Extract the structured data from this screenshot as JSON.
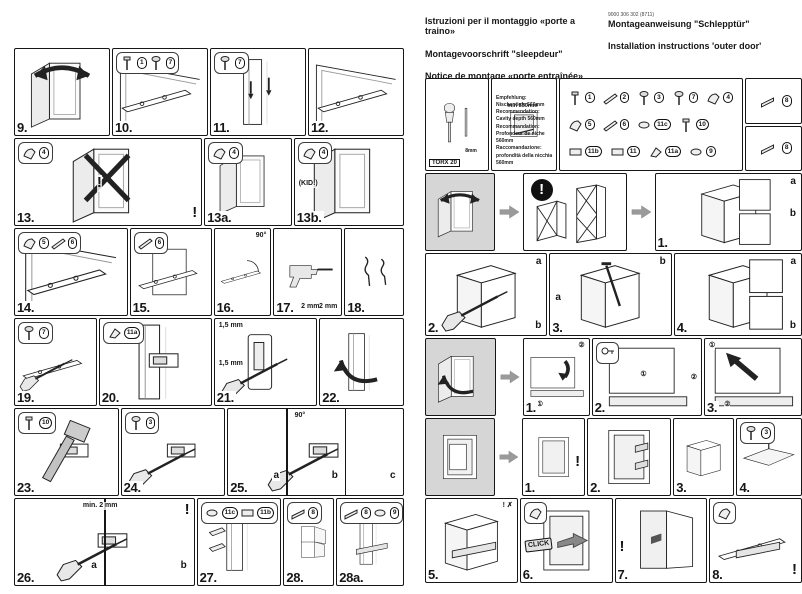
{
  "document": {
    "kind": "scanned appliance installation manual, two pages",
    "page_bg": "#ffffff",
    "ink": "#161616",
    "gray_fill": "#d6d6d6"
  },
  "header": {
    "doc_code": "9000 306 302 (8711)",
    "title_it": "Istruzioni per il montaggio «porte a traino»",
    "title_de": "Montageanweisung \"Schlepptür\"",
    "title_nl": "Montagevoorschrift \"sleepdeur\"",
    "title_en": "Installation instructions 'outer door'",
    "title_fr": "Notice de montage «porte entraînée»"
  },
  "tools_box": {
    "tool_label": "TORX 20",
    "bit_label": "8mm"
  },
  "niche_box": {
    "dim_label": "min 550mm",
    "recommendations": [
      "Empfehlung: Nischentiefe 560mm",
      "Recommendation: Cavity depth 560mm",
      "Recommandation: Profondeur de niche 560mm",
      "Raccomandazione: profondità della nicchia 560mm"
    ]
  },
  "parts_box": {
    "main_parts": [
      {
        "id": "1",
        "icon": "pin-icon"
      },
      {
        "id": "2",
        "icon": "rail-icon"
      },
      {
        "id": "3",
        "icon": "screw-icon"
      },
      {
        "id": "7",
        "icon": "screw-icon"
      },
      {
        "id": "4",
        "icon": "bracket-icon"
      },
      {
        "id": "5",
        "icon": "bracket-icon"
      },
      {
        "id": "6",
        "icon": "rail-icon"
      },
      {
        "id": "11c",
        "icon": "cap-icon"
      },
      {
        "id": "10",
        "icon": "pin-icon"
      },
      {
        "id": "11b",
        "icon": "slider-icon"
      },
      {
        "id": "11",
        "icon": "slider-icon"
      },
      {
        "id": "11a",
        "icon": "clip-icon"
      },
      {
        "id": "9",
        "icon": "cap-icon"
      }
    ],
    "side_parts": [
      {
        "id": "8",
        "icon": "strip-icon"
      },
      {
        "id": "8",
        "icon": "strip-icon"
      }
    ]
  },
  "left_page": {
    "rows": [
      {
        "steps": [
          {
            "label": "9.",
            "art": [
              "door",
              "arrowCurve"
            ]
          },
          {
            "label": "10.",
            "art": [
              "frame",
              "bar"
            ],
            "insets": [
              {
                "parts": [
                  "1",
                  "7"
                ]
              }
            ]
          },
          {
            "label": "11.",
            "art": [
              "doorEdge",
              "screwPair"
            ],
            "insets": [
              {
                "parts": [
                  "7"
                ]
              }
            ]
          },
          {
            "label": "12.",
            "art": [
              "frame",
              "bar"
            ]
          }
        ]
      },
      {
        "steps": [
          {
            "label": "13.",
            "art": [
              "door",
              "crossX"
            ],
            "insets": [
              {
                "parts": [
                  "4"
                ]
              }
            ],
            "notes": [
              {
                "t": "!",
                "pos": "c"
              },
              {
                "t": "!",
                "pos": "br"
              }
            ]
          },
          {
            "label": "13a.",
            "art": [
              "door"
            ],
            "insets": [
              {
                "parts": [
                  "4"
                ]
              }
            ]
          },
          {
            "label": "13b.",
            "art": [
              "door"
            ],
            "insets": [
              {
                "parts": [
                  "4"
                ]
              }
            ],
            "notes": [
              {
                "t": "(KID!)",
                "pos": "cl"
              }
            ]
          }
        ]
      },
      {
        "steps": [
          {
            "label": "14.",
            "art": [
              "frame",
              "bar"
            ],
            "insets": [
              {
                "parts": [
                  "5",
                  "6"
                ]
              }
            ]
          },
          {
            "label": "15.",
            "art": [
              "doorPanel",
              "bar"
            ],
            "insets": [
              {
                "parts": [
                  "6"
                ]
              }
            ]
          },
          {
            "label": "16.",
            "art": [
              "bar",
              "arc90"
            ],
            "notes": [
              {
                "t": "90°",
                "pos": "tr"
              }
            ]
          },
          {
            "label": "17.",
            "art": [
              "drillP"
            ],
            "notes": [
              {
                "t": "2 mm",
                "pos": "bc"
              },
              {
                "t": "2 mm",
                "pos": "br"
              }
            ]
          },
          {
            "label": "18.",
            "art": [
              "clipsP"
            ]
          }
        ]
      },
      {
        "steps": [
          {
            "label": "19.",
            "art": [
              "bar",
              "driver"
            ],
            "insets": [
              {
                "parts": [
                  "7"
                ]
              }
            ]
          },
          {
            "label": "20.",
            "art": [
              "doorEdge",
              "sliderRect"
            ],
            "insets": [
              {
                "parts": [
                  "11a"
                ]
              }
            ]
          },
          {
            "label": "21.",
            "art": [
              "plate",
              "driver"
            ],
            "notes": [
              {
                "t": "1,5 mm",
                "pos": "tl"
              },
              {
                "t": "1,5 mm",
                "pos": "cl"
              }
            ]
          },
          {
            "label": "22.",
            "art": [
              "doorEdge",
              "turnArrow"
            ]
          }
        ]
      },
      {
        "steps": [
          {
            "label": "23.",
            "art": [
              "sliderRect",
              "hammerP"
            ],
            "insets": [
              {
                "parts": [
                  "10"
                ]
              }
            ]
          },
          {
            "label": "24.",
            "art": [
              "sliderRect",
              "driver"
            ],
            "insets": [
              {
                "parts": [
                  "3"
                ]
              }
            ]
          },
          {
            "label": "25.",
            "art": [
              "sliderRect",
              "driver"
            ],
            "panels": 3,
            "subs": [
              {
                "t": "a"
              },
              {
                "t": "b"
              },
              {
                "t": "c"
              }
            ],
            "notes": [
              {
                "t": "90°",
                "pos": "t"
              }
            ]
          }
        ]
      },
      {
        "steps": [
          {
            "label": "26.",
            "art": [
              "sliderRect",
              "driver"
            ],
            "panels": 2,
            "subs": [
              {
                "t": "a"
              },
              {
                "t": "b"
              }
            ],
            "notes": [
              {
                "t": "min. 2 mm",
                "pos": "t"
              },
              {
                "t": "!",
                "pos": "tr"
              }
            ]
          },
          {
            "label": "27.",
            "art": [
              "doorEdge",
              "capsP"
            ],
            "insets": [
              {
                "parts": [
                  "11c",
                  "11b"
                ]
              }
            ]
          },
          {
            "label": "28.",
            "art": [
              "tallCab"
            ],
            "insets": [
              {
                "parts": [
                  "8"
                ]
              }
            ]
          },
          {
            "label": "28a.",
            "art": [
              "doorEdge",
              "stripP"
            ],
            "insets": [
              {
                "parts": [
                  "8",
                  "9"
                ]
              }
            ]
          }
        ]
      }
    ]
  },
  "right_page": {
    "rows": [
      {
        "items": [
          {
            "kind": "tools"
          },
          {
            "kind": "niche"
          },
          {
            "kind": "parts"
          },
          {
            "kind": "parts_side"
          }
        ]
      },
      {
        "items": [
          {
            "kind": "intro",
            "art": [
              "door",
              "arrowCurve"
            ]
          },
          {
            "kind": "arrow",
            "icon": "block-arrow-right-icon"
          },
          {
            "kind": "warn",
            "art": [
              "cabX"
            ],
            "icon": "exclamation-icon",
            "icon_text": "!"
          },
          {
            "kind": "arrow",
            "icon": "block-arrow-right-icon"
          },
          {
            "kind": "step",
            "label": "1.",
            "art": [
              "iso",
              "detailBoxes"
            ],
            "subs": [
              {
                "t": "a",
                "pos": "tr"
              },
              {
                "t": "b",
                "pos": "cr"
              }
            ]
          }
        ]
      },
      {
        "items": [
          {
            "kind": "step",
            "label": "2.",
            "art": [
              "iso",
              "driver"
            ],
            "subs": [
              {
                "t": "a",
                "pos": "tr"
              },
              {
                "t": "b",
                "pos": "br"
              }
            ]
          },
          {
            "kind": "step",
            "label": "3.",
            "art": [
              "iso",
              "pinP"
            ],
            "subs": [
              {
                "t": "a",
                "pos": "cl"
              },
              {
                "t": "b",
                "pos": "tr"
              }
            ]
          },
          {
            "kind": "step",
            "label": "4.",
            "art": [
              "iso",
              "detailBoxes"
            ],
            "subs": [
              {
                "t": "a",
                "pos": "tr"
              },
              {
                "t": "b",
                "pos": "br"
              }
            ]
          }
        ]
      },
      {
        "items": [
          {
            "kind": "intro",
            "art": [
              "door",
              "turnArrow"
            ]
          },
          {
            "kind": "arrow",
            "icon": "block-arrow-right-icon"
          },
          {
            "kind": "step",
            "label": "1.",
            "art": [
              "panelBig",
              "bendArrow"
            ],
            "notes": [
              {
                "t": "②",
                "pos": "tr"
              },
              {
                "t": "①",
                "pos": "bl2"
              }
            ]
          },
          {
            "kind": "step",
            "label": "2.",
            "art": [
              "panelBig"
            ],
            "insets": [
              {
                "icons": [
                  "key-icon"
                ]
              }
            ],
            "notes": [
              {
                "t": "①",
                "pos": "c"
              },
              {
                "t": "②",
                "pos": "cr"
              }
            ]
          },
          {
            "kind": "step",
            "label": "3.",
            "art": [
              "panelBig",
              "arrowUL"
            ],
            "notes": [
              {
                "t": "①",
                "pos": "tl"
              },
              {
                "t": "②",
                "pos": "bl2"
              }
            ]
          }
        ]
      },
      {
        "items": [
          {
            "kind": "intro",
            "art": [
              "nicheFridge"
            ]
          },
          {
            "kind": "arrow",
            "icon": "block-arrow-right-icon"
          },
          {
            "kind": "step",
            "label": "1.",
            "art": [
              "niche"
            ],
            "notes": [
              {
                "t": "!",
                "pos": "cr"
              }
            ]
          },
          {
            "kind": "step",
            "label": "2.",
            "art": [
              "niche",
              "bracketPair"
            ]
          },
          {
            "kind": "step",
            "label": "3.",
            "art": [
              "iso"
            ]
          },
          {
            "kind": "step",
            "label": "4.",
            "art": [
              "cornerScrew"
            ],
            "insets": [
              {
                "parts": [
                  "3"
                ]
              }
            ]
          }
        ]
      },
      {
        "items": [
          {
            "kind": "step",
            "label": "5.",
            "art": [
              "iso",
              "stripP"
            ],
            "notes": [
              {
                "t": "! ✗",
                "pos": "tr"
              }
            ]
          },
          {
            "kind": "step",
            "label": "6.",
            "art": [
              "niche",
              "blockSmall"
            ],
            "insets": [
              {
                "icons": [
                  "bracket-icon"
                ]
              }
            ],
            "notes": [
              {
                "t": "CLICK",
                "pos": "cl"
              }
            ]
          },
          {
            "kind": "step",
            "label": "7.",
            "art": [
              "openDoorTall"
            ],
            "notes": [
              {
                "t": "!",
                "pos": "cl"
              }
            ]
          },
          {
            "kind": "step",
            "label": "8.",
            "art": [
              "bar",
              "stripP"
            ],
            "insets": [
              {
                "icons": [
                  "bracket-icon"
                ]
              }
            ],
            "notes": [
              {
                "t": "!",
                "pos": "br"
              }
            ]
          }
        ]
      }
    ]
  }
}
